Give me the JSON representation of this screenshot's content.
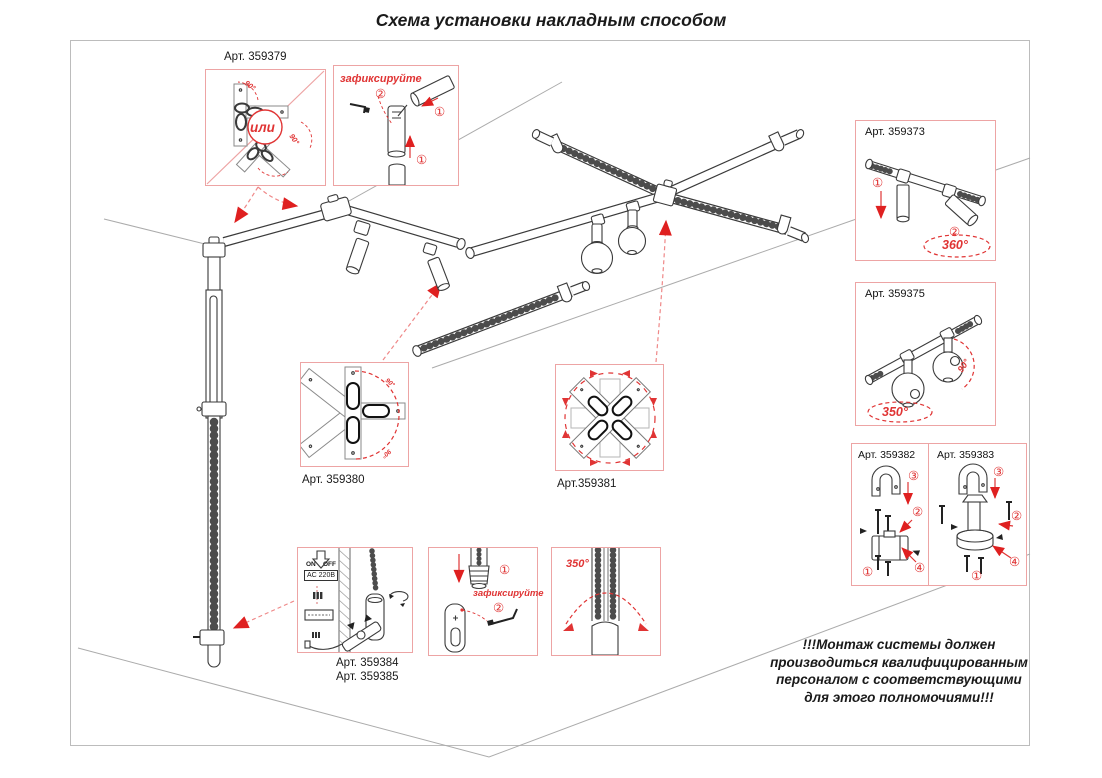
{
  "title": "Схема установки накладным способом",
  "colors": {
    "annotation_red": "#e03434",
    "box_border": "#eda4a4",
    "line_dark": "#3a3a3a",
    "line_gray": "#ababab"
  },
  "insets": {
    "a379": {
      "label": "Арт. 359379",
      "or_label": "или",
      "angle1": "90°",
      "angle2": "90°"
    },
    "fix_top": {
      "caption": "зафиксируйте",
      "s1": "①",
      "s2": "②",
      "s1b": "①"
    },
    "a373": {
      "label": "Арт. 359373",
      "s1": "①",
      "s2": "②",
      "angle": "360°"
    },
    "a375": {
      "label": "Арт. 359375",
      "angle": "350°",
      "tilt": "90°"
    },
    "a382": {
      "label": "Арт. 359382",
      "s1": "①",
      "s2": "②",
      "s3": "③",
      "s4": "④"
    },
    "a383": {
      "label": "Арт. 359383",
      "s1": "①",
      "s2": "②",
      "s3": "③",
      "s4": "④"
    },
    "a380": {
      "label": "Арт. 359380",
      "angle1": "90°",
      "angle2": "90°"
    },
    "a381": {
      "label": "Арт.359381"
    },
    "a384": {
      "label1": "Арт. 359384",
      "label2": "Арт. 359385",
      "on": "ON",
      "off": "OFF",
      "voltage": "AC 220В"
    },
    "fix_bottom": {
      "caption": "зафиксируйте",
      "s1": "①",
      "s2": "②"
    },
    "rot350": {
      "angle": "350°"
    }
  },
  "warning": {
    "l1": "!!!Монтаж системы должен",
    "l2": "производиться квалифицированным",
    "l3": "персоналом с соответствующими",
    "l4": "для этого полномочиями!!!"
  }
}
